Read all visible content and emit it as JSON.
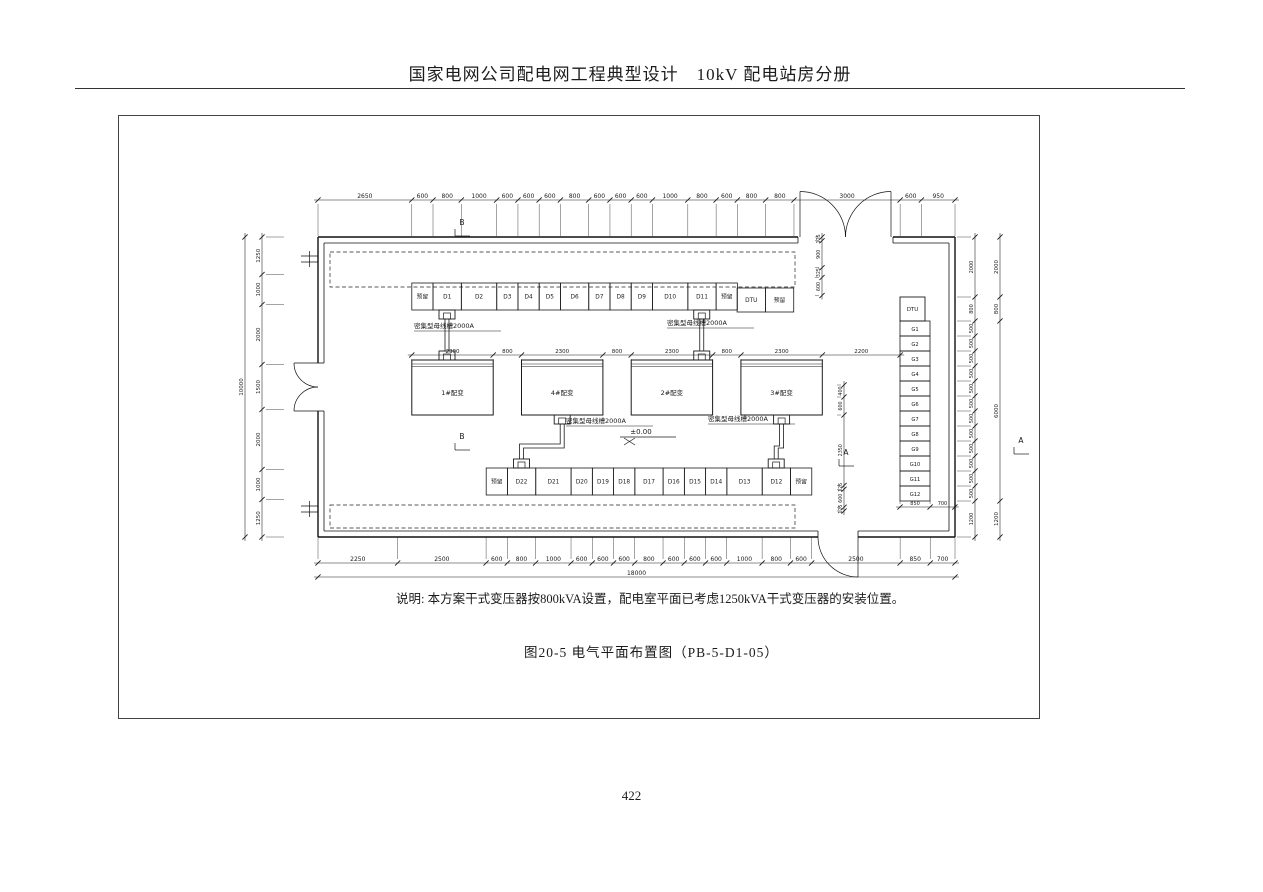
{
  "header": {
    "title": "国家电网公司配电网工程典型设计　10kV 配电站房分册"
  },
  "note": "说明: 本方案干式变压器按800kVA设置，配电室平面已考虑1250kVA干式变压器的安装位置。",
  "caption": "图20-5  电气平面布置图（PB-5-D1-05）",
  "footer": {
    "page_number": "422"
  },
  "plan": {
    "busbar_label": "密集型母线槽2000A",
    "level_mark": "±0.00",
    "markers": {
      "a": "A",
      "b": "B"
    },
    "reserved_label": "预留",
    "transformers": [
      {
        "label": "1#配变",
        "conn": "top"
      },
      {
        "label": "4#配变",
        "conn": "bottom"
      },
      {
        "label": "2#配变",
        "conn": "top"
      },
      {
        "label": "3#配变",
        "conn": "bottom"
      }
    ],
    "top_row": [
      {
        "label": "预留",
        "w": 600
      },
      {
        "label": "D1",
        "w": 800
      },
      {
        "label": "D2",
        "w": 1000
      },
      {
        "label": "D3",
        "w": 600
      },
      {
        "label": "D4",
        "w": 600
      },
      {
        "label": "D5",
        "w": 600
      },
      {
        "label": "D6",
        "w": 800
      },
      {
        "label": "D7",
        "w": 600
      },
      {
        "label": "D8",
        "w": 600
      },
      {
        "label": "D9",
        "w": 600
      },
      {
        "label": "D10",
        "w": 1000
      },
      {
        "label": "D11",
        "w": 800
      },
      {
        "label": "预留",
        "w": 600
      }
    ],
    "aux_row": [
      {
        "label": "DTU",
        "w": 800
      },
      {
        "label": "预留",
        "w": 800
      }
    ],
    "bottom_row": [
      {
        "label": "预留",
        "w": 600
      },
      {
        "label": "D22",
        "w": 800
      },
      {
        "label": "D21",
        "w": 1000
      },
      {
        "label": "D20",
        "w": 600
      },
      {
        "label": "D19",
        "w": 600
      },
      {
        "label": "D18",
        "w": 600
      },
      {
        "label": "D17",
        "w": 800
      },
      {
        "label": "D16",
        "w": 600
      },
      {
        "label": "D15",
        "w": 600
      },
      {
        "label": "D14",
        "w": 600
      },
      {
        "label": "D13",
        "w": 1000
      },
      {
        "label": "D12",
        "w": 800
      },
      {
        "label": "预留",
        "w": 600
      }
    ],
    "right_column": {
      "top": "DTU",
      "cells": [
        "G1",
        "G2",
        "G3",
        "G4",
        "G5",
        "G6",
        "G7",
        "G8",
        "G9",
        "G10",
        "G11",
        "G12"
      ]
    },
    "dims": {
      "top": [
        2650,
        600,
        800,
        1000,
        600,
        600,
        600,
        800,
        600,
        600,
        600,
        1000,
        800,
        600,
        800,
        800,
        3000,
        600,
        950
      ],
      "bottom": [
        2250,
        2500,
        600,
        800,
        1000,
        600,
        600,
        600,
        800,
        600,
        600,
        600,
        1000,
        800,
        600,
        2500,
        850,
        700
      ],
      "bottom_total": 18000,
      "left": [
        1250,
        1000,
        2000,
        1500,
        2000,
        1000,
        1250
      ],
      "left_total": 10000,
      "right_inner": [
        2000,
        800,
        500,
        500,
        500,
        500,
        500,
        500,
        500,
        500,
        500,
        500,
        500,
        500,
        1200
      ],
      "right_outer": [
        2000,
        800,
        6000,
        1200
      ],
      "transformer_row": [
        2300,
        800,
        2300,
        800,
        2300,
        800,
        2300,
        2200
      ],
      "g_bottom": [
        850,
        700
      ],
      "right_top_inside": [
        125,
        900,
        325,
        600
      ],
      "mid_right": [
        400,
        600,
        2350,
        125,
        600,
        125
      ]
    }
  }
}
